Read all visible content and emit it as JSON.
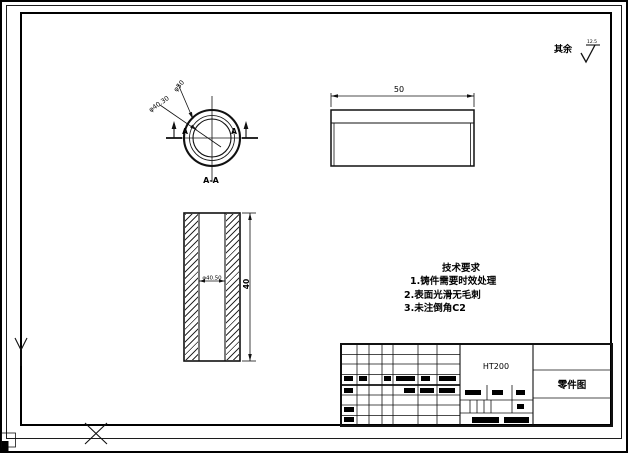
{
  "section_view": {
    "title": "A-A",
    "dim_outer": "φ50",
    "dim_inner": "φ40.30",
    "cut_label_left": "A",
    "cut_label_right": "A"
  },
  "side_view": {
    "dim_width": "50"
  },
  "front_view": {
    "dim_bore": "φ40.50",
    "dim_length": "40"
  },
  "tech": {
    "title": "技术要求",
    "items": [
      "1.铸件需要时效处理",
      "2.表面光滑无毛刺",
      "3.未注倒角C2"
    ]
  },
  "surface_note": {
    "label": "其余",
    "roughness": "12.5"
  },
  "title_block": {
    "material": "HT200",
    "doc_name": "零件图"
  }
}
